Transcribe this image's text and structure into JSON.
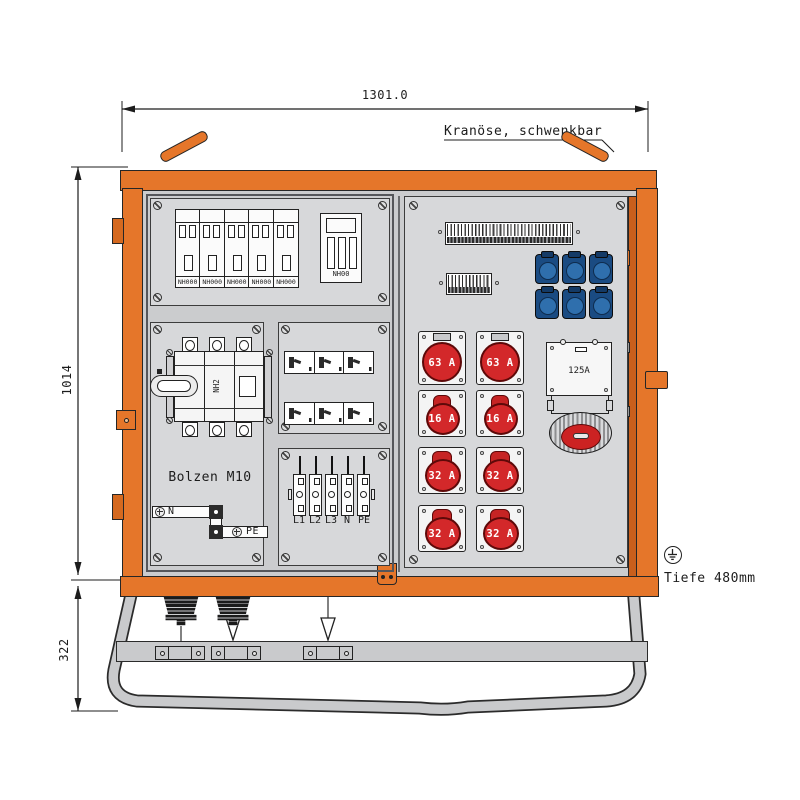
{
  "dimensions": {
    "width": "1301.0",
    "height": "1014",
    "stand_height": "322",
    "depth": "Tiefe 480mm"
  },
  "labels": {
    "crane": "Kranöse, schwenkbar",
    "bolt": "Bolzen M10"
  },
  "left_panel": {
    "fuse_strips": [
      {
        "label": "NH000"
      },
      {
        "label": "NH000"
      },
      {
        "label": "NH000"
      },
      {
        "label": "NH000"
      },
      {
        "label": "NH000"
      }
    ],
    "fuse_switch": {
      "label": "NH00"
    },
    "main_switch": {
      "label": "NH2"
    },
    "busbar_n": "N",
    "busbar_pe": "PE",
    "terminals": [
      {
        "label": "L1"
      },
      {
        "label": "L2"
      },
      {
        "label": "L3"
      },
      {
        "label": "N"
      },
      {
        "label": "PE"
      }
    ]
  },
  "door_panel": {
    "cee_sockets": [
      {
        "label": "63 A"
      },
      {
        "label": "63 A"
      },
      {
        "label": "16 A"
      },
      {
        "label": "16 A"
      },
      {
        "label": "32 A"
      },
      {
        "label": "32 A"
      },
      {
        "label": "32 A"
      },
      {
        "label": "32 A"
      }
    ],
    "large_socket": {
      "label": "125A"
    }
  },
  "colors": {
    "frame_orange": "#e5762a",
    "socket_red": "#d3282a",
    "socket_blue": "#1a4b82",
    "panel_grey": "#d7d8da"
  }
}
